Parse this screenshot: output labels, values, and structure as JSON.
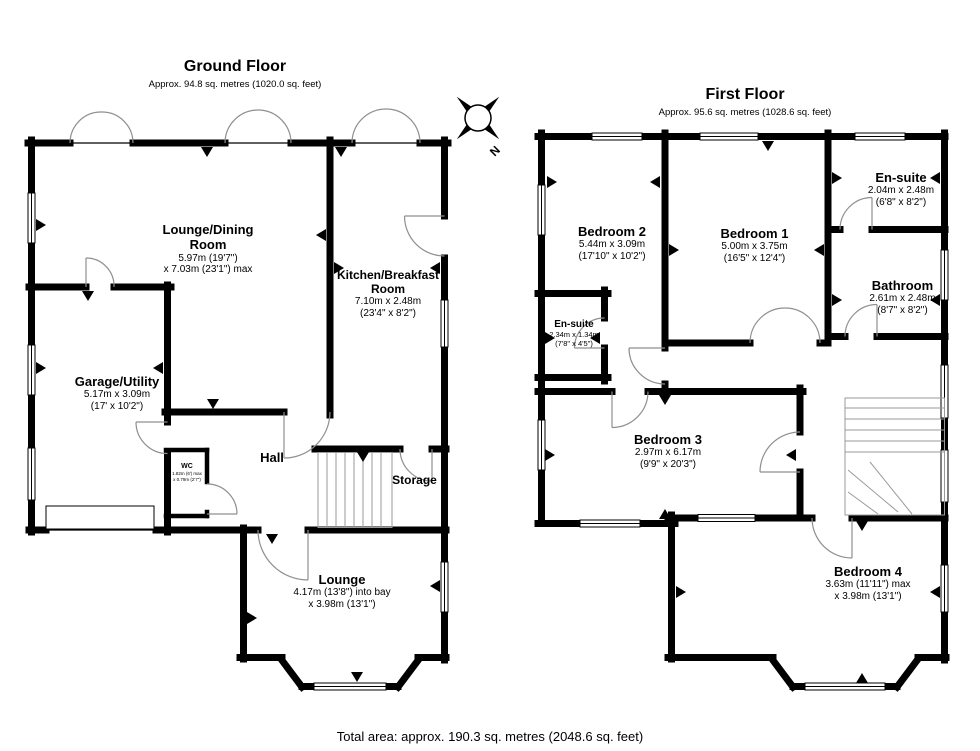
{
  "footer": {
    "total_area": "Total area: approx. 190.3 sq. metres (2048.6 sq. feet)"
  },
  "compass": {
    "label": "N"
  },
  "ground_floor": {
    "title": "Ground Floor",
    "subtitle": "Approx. 94.8 sq. metres (1020.0 sq. feet)",
    "rooms": {
      "lounge_dining": {
        "name": "Lounge/Dining Room",
        "dim1": "5.97m (19'7\")",
        "dim2": "x 7.03m (23'1\") max"
      },
      "kitchen": {
        "name": "Kitchen/Breakfast Room",
        "dim1": "7.10m x 2.48m",
        "dim2": "(23'4\" x 8'2\")"
      },
      "garage": {
        "name": "Garage/Utility",
        "dim1": "5.17m x 3.09m",
        "dim2": "(17' x 10'2\")"
      },
      "wc": {
        "name": "WC",
        "dim1": "1.82m (6') max",
        "dim2": "x 0.79m (2'7\")"
      },
      "hall": {
        "name": "Hall"
      },
      "storage": {
        "name": "Storage"
      },
      "lounge": {
        "name": "Lounge",
        "dim1": "4.17m (13'8\") into bay",
        "dim2": "x 3.98m (13'1\")"
      }
    }
  },
  "first_floor": {
    "title": "First Floor",
    "subtitle": "Approx. 95.6 sq. metres (1028.6 sq. feet)",
    "rooms": {
      "bedroom2": {
        "name": "Bedroom 2",
        "dim1": "5.44m x 3.09m",
        "dim2": "(17'10\" x 10'2\")"
      },
      "bedroom1": {
        "name": "Bedroom 1",
        "dim1": "5.00m x 3.75m",
        "dim2": "(16'5\" x 12'4\")"
      },
      "ensuite1": {
        "name": "En-suite",
        "dim1": "2.04m x 2.48m",
        "dim2": "(6'8\" x 8'2\")"
      },
      "bathroom": {
        "name": "Bathroom",
        "dim1": "2.61m x 2.48m",
        "dim2": "(8'7\" x 8'2\")"
      },
      "ensuite2": {
        "name": "En-suite",
        "dim1": "2.34m x 1.34m",
        "dim2": "(7'8\" x 4'5\")"
      },
      "bedroom3": {
        "name": "Bedroom 3",
        "dim1": "2.97m x 6.17m",
        "dim2": "(9'9\" x 20'3\")"
      },
      "bedroom4": {
        "name": "Bedroom 4",
        "dim1": "3.63m (11'11\") max",
        "dim2": "x 3.98m (13'1\")"
      }
    }
  },
  "colors": {
    "wall": "#000000",
    "door_arc": "#8f8f8f",
    "stairs": "#9a9a9a"
  }
}
